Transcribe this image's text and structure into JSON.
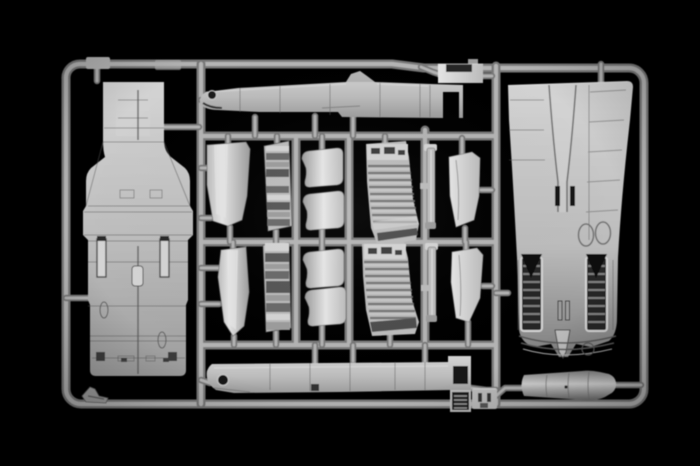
{
  "scene": {
    "description": "Photograph of a light-grey injection-moulded model-kit sprue (parts frame) holding aircraft fuselage and detail parts, lit against a black background",
    "background": "black",
    "material": "light grey polystyrene plastic"
  },
  "colors": {
    "background": "#000000",
    "plasticXLight": "#e6e6e6",
    "plasticLight": "#d4d4d4",
    "plastic": "#bcbcbc",
    "plasticMid": "#9c9c9c",
    "plasticDark": "#7f7f7f",
    "plasticShadow": "#696969",
    "frameHi": "#b4b4b4",
    "frameCore": "#787878",
    "panelLine": "#565656",
    "recessDark": "#141414"
  },
  "sprue": {
    "frame": {
      "outer_bounds_px": [
        62,
        56,
        648,
        408
      ],
      "vertical_runners_x": [
        201,
        296,
        349,
        425,
        496
      ],
      "horizontal_runners_y": [
        136,
        242,
        345
      ]
    },
    "parts": [
      {
        "name": "upper fuselage half",
        "bbox": [
          83,
          82,
          193,
          376
        ]
      },
      {
        "name": "fuselage spine side section",
        "bbox": [
          199,
          71,
          463,
          119
        ]
      },
      {
        "name": "spine insert block",
        "bbox": [
          438,
          59,
          483,
          83
        ]
      },
      {
        "name": "aft fuselage with engine bays",
        "bbox": [
          508,
          81,
          633,
          358
        ]
      },
      {
        "name": "intake splitter panel upper",
        "bbox": [
          206,
          142,
          250,
          227
        ]
      },
      {
        "name": "detail console upper",
        "bbox": [
          264,
          141,
          292,
          231
        ]
      },
      {
        "name": "intake lip segment 1",
        "bbox": [
          302,
          148,
          343,
          188
        ]
      },
      {
        "name": "intake lip segment 2",
        "bbox": [
          303,
          191,
          344,
          231
        ]
      },
      {
        "name": "ribbed intake ramp upper",
        "bbox": [
          365,
          141,
          419,
          246
        ]
      },
      {
        "name": "actuator strut upper",
        "bbox": [
          420,
          144,
          437,
          229
        ]
      },
      {
        "name": "blade fin upper",
        "bbox": [
          449,
          152,
          481,
          227
        ]
      },
      {
        "name": "intake splitter panel lower",
        "bbox": [
          218,
          247,
          249,
          336
        ]
      },
      {
        "name": "detail console lower",
        "bbox": [
          263,
          243,
          291,
          332
        ]
      },
      {
        "name": "intake lip segment 3",
        "bbox": [
          303,
          249,
          344,
          289
        ]
      },
      {
        "name": "intake lip segment 4",
        "bbox": [
          305,
          287,
          346,
          327
        ]
      },
      {
        "name": "ribbed intake ramp lower",
        "bbox": [
          362,
          242,
          419,
          336
        ]
      },
      {
        "name": "actuator strut lower",
        "bbox": [
          421,
          243,
          437,
          322
        ]
      },
      {
        "name": "blade fin lower",
        "bbox": [
          451,
          248,
          483,
          322
        ]
      },
      {
        "name": "lower fuselage side section",
        "bbox": [
          204,
          355,
          471,
          393
        ]
      },
      {
        "name": "vent grille",
        "bbox": [
          451,
          390,
          470,
          412
        ]
      },
      {
        "name": "access plate",
        "bbox": [
          472,
          388,
          497,
          409
        ]
      },
      {
        "name": "tail cone",
        "bbox": [
          520,
          370,
          616,
          400
        ]
      },
      {
        "name": "small bracket",
        "bbox": [
          82,
          386,
          108,
          403
        ]
      }
    ]
  }
}
